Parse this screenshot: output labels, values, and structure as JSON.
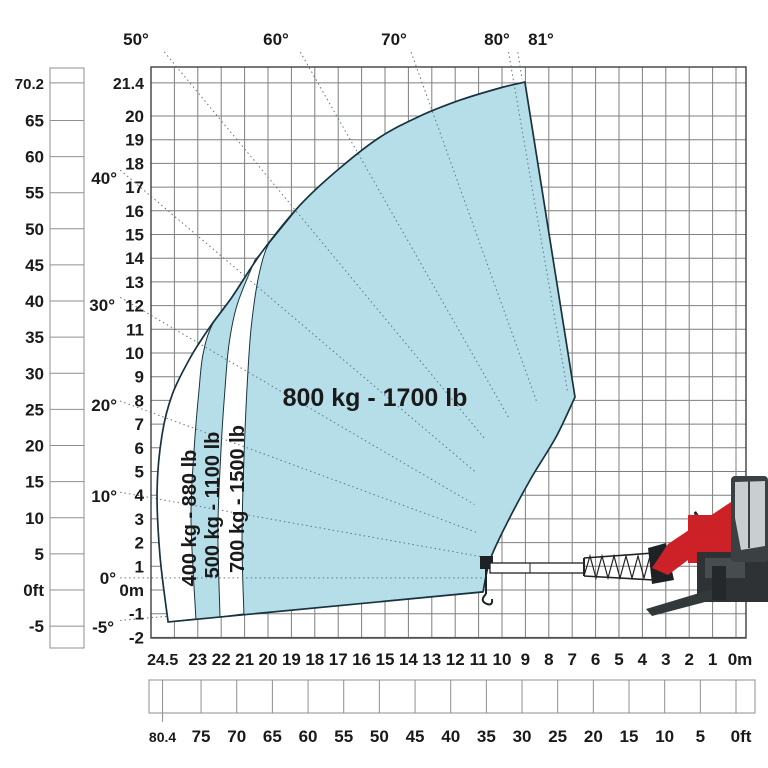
{
  "machine": {
    "logo_text": "M"
  },
  "chart_data": {
    "type": "area",
    "title": "",
    "zones": [
      {
        "label": "400 kg - 880 lb",
        "kg": 400,
        "lb": 880
      },
      {
        "label": "500 kg - 1100 lb",
        "kg": 500,
        "lb": 1100
      },
      {
        "label": "700 kg - 1500 lb",
        "kg": 700,
        "lb": 1500
      },
      {
        "label": "800 kg - 1700 lb",
        "kg": 800,
        "lb": 1700
      }
    ],
    "angles": [
      {
        "deg": -5,
        "label": "-5°",
        "r1": 20.59,
        "r2": 18.55,
        "lx": 114,
        "ly": 633,
        "anchor": "end"
      },
      {
        "deg": 0,
        "label": "0°",
        "r1": 20.51,
        "r2": 5.0,
        "lx": 116,
        "ly": 584,
        "anchor": "end"
      },
      {
        "deg": 10,
        "label": "10°",
        "r1": 20.83,
        "r2": 5.2,
        "lx": 117,
        "ly": 502,
        "anchor": "end"
      },
      {
        "deg": 20,
        "label": "20°",
        "r1": 21.83,
        "r2": 5.6,
        "lx": 117,
        "ly": 411,
        "anchor": "end"
      },
      {
        "deg": 30,
        "label": "30°",
        "r1": 23.68,
        "r2": 6.2,
        "lx": 115,
        "ly": 311,
        "anchor": "end"
      },
      {
        "deg": 40,
        "label": "40°",
        "r1": 26.77,
        "r2": 7.0,
        "lx": 117,
        "ly": 184,
        "anchor": "end"
      },
      {
        "deg": 50,
        "label": "50°",
        "r1": 28.97,
        "r2": 7.6,
        "lx": 136,
        "ly": 45,
        "anchor": "middle"
      },
      {
        "deg": 60,
        "label": "60°",
        "r1": 25.62,
        "r2": 7.8,
        "lx": 276,
        "ly": 45,
        "anchor": "middle"
      },
      {
        "deg": 70,
        "label": "70°",
        "r1": 23.61,
        "r2": 7.9,
        "lx": 394,
        "ly": 45,
        "anchor": "middle"
      },
      {
        "deg": 80,
        "label": "80°",
        "r1": 22.53,
        "r2": 8.0,
        "lx": 497,
        "ly": 45,
        "anchor": "middle"
      },
      {
        "deg": 81,
        "label": "81°",
        "r1": 22.46,
        "r2": 21.3,
        "lx": 541,
        "ly": 45,
        "anchor": "middle"
      }
    ],
    "x_axis_m": {
      "unit": "m",
      "max": 24.5,
      "labels": [
        "24.5",
        "23",
        "22",
        "21",
        "20",
        "19",
        "18",
        "17",
        "16",
        "15",
        "14",
        "13",
        "12",
        "11",
        "10",
        "9",
        "8",
        "7",
        "6",
        "5",
        "4",
        "3",
        "2",
        "1",
        "0m"
      ],
      "values": [
        24.5,
        23,
        22,
        21,
        20,
        19,
        18,
        17,
        16,
        15,
        14,
        13,
        12,
        11,
        10,
        9,
        8,
        7,
        6,
        5,
        4,
        3,
        2,
        1,
        0
      ]
    },
    "x_axis_ft": {
      "unit": "ft",
      "max": 80.4,
      "labels": [
        "80.4",
        "75",
        "70",
        "65",
        "60",
        "55",
        "50",
        "45",
        "40",
        "35",
        "30",
        "25",
        "20",
        "15",
        "10",
        "5",
        "0ft"
      ],
      "values": [
        80.4,
        75,
        70,
        65,
        60,
        55,
        50,
        45,
        40,
        35,
        30,
        25,
        20,
        15,
        10,
        5,
        0
      ]
    },
    "y_axis_m": {
      "unit": "m",
      "max": 21.4,
      "labels": [
        "21.4",
        "20",
        "19",
        "18",
        "17",
        "16",
        "15",
        "14",
        "13",
        "12",
        "11",
        "10",
        "9",
        "8",
        "7",
        "6",
        "5",
        "4",
        "3",
        "2",
        "1",
        "0m",
        "-1",
        "-2"
      ],
      "values": [
        21.4,
        20,
        19,
        18,
        17,
        16,
        15,
        14,
        13,
        12,
        11,
        10,
        9,
        8,
        7,
        6,
        5,
        4,
        3,
        2,
        1,
        0,
        -1,
        -2
      ]
    },
    "y_axis_ft": {
      "unit": "ft",
      "max": 70.2,
      "labels": [
        "70.2",
        "65",
        "60",
        "55",
        "50",
        "45",
        "40",
        "35",
        "30",
        "25",
        "20",
        "15",
        "10",
        "5",
        "0ft",
        "-5"
      ],
      "values": [
        70.2,
        65,
        60,
        55,
        50,
        45,
        40,
        35,
        30,
        25,
        20,
        15,
        10,
        5,
        0,
        -5
      ]
    },
    "pivot_m": {
      "d": 5.81,
      "h": 0.51
    },
    "envelope_m": {
      "outer": [
        [
          24.27,
          -1.35
        ],
        [
          24.62,
          1.48
        ],
        [
          24.74,
          4.22
        ],
        [
          24.53,
          6.54
        ],
        [
          24.1,
          8.23
        ],
        [
          23.33,
          9.79
        ],
        [
          22.48,
          11.1
        ],
        [
          21.54,
          12.36
        ],
        [
          20.26,
          14.26
        ],
        [
          18.63,
          16.24
        ],
        [
          16.92,
          17.81
        ],
        [
          15.21,
          19.11
        ],
        [
          13.5,
          20.0
        ],
        [
          11.79,
          20.67
        ],
        [
          10.09,
          21.18
        ],
        [
          9.02,
          21.43
        ]
      ],
      "right_corner": [
        6.88,
        8.14
      ],
      "concave": [
        [
          6.88,
          8.14
        ],
        [
          7.69,
          6.46
        ],
        [
          8.8,
          4.64
        ],
        [
          9.83,
          2.74
        ],
        [
          10.51,
          1.27
        ],
        [
          10.81,
          -0.08
        ]
      ],
      "b1": [
        [
          21.54,
          12.36
        ],
        [
          22.39,
          11.18
        ],
        [
          22.78,
          9.92
        ],
        [
          22.95,
          8.44
        ],
        [
          23.16,
          5.91
        ],
        [
          23.29,
          2.95
        ],
        [
          23.08,
          -1.22
        ]
      ],
      "b2": [
        [
          20.56,
          13.92
        ],
        [
          21.32,
          12.03
        ],
        [
          21.67,
          10.34
        ],
        [
          21.84,
          8.44
        ],
        [
          22.01,
          5.91
        ],
        [
          22.14,
          2.53
        ],
        [
          22.05,
          -1.14
        ]
      ],
      "b3": [
        [
          18.63,
          16.24
        ],
        [
          19.36,
          15.4
        ],
        [
          20.04,
          14.47
        ],
        [
          20.43,
          13.08
        ],
        [
          20.73,
          10.97
        ],
        [
          20.9,
          8.44
        ],
        [
          21.03,
          5.49
        ],
        [
          21.11,
          2.11
        ],
        [
          21.03,
          -1.01
        ]
      ]
    },
    "colors": {
      "zone_fill": "#b6dee9",
      "boundary": "#17333f",
      "grid": "#7f7f7f",
      "grid_border": "#3f3f3f",
      "dotted": "#5f7781",
      "ruler": "#8f8f8f",
      "machine_red": "#cc2127",
      "machine_dark": "#2e3234",
      "cab_glass": "#c9cfd1"
    }
  }
}
